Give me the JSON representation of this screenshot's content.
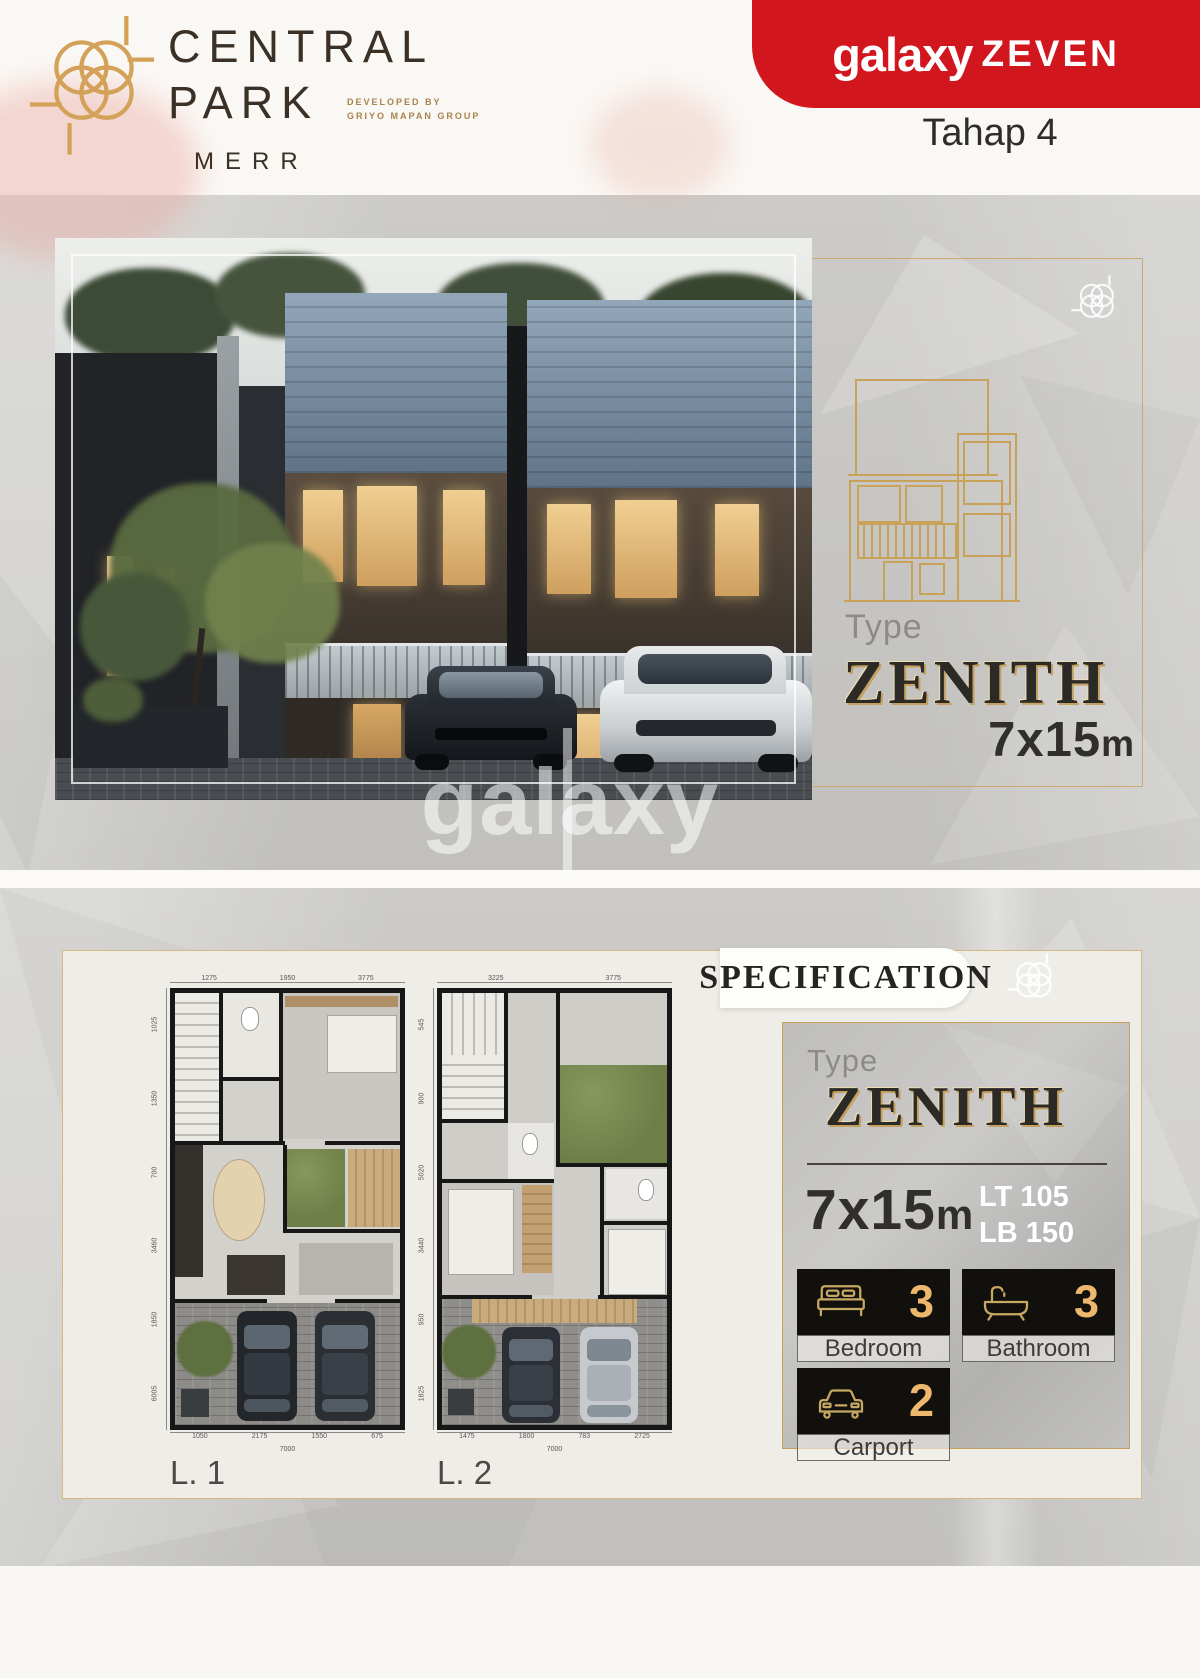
{
  "brand": {
    "line1": "CENTRAL",
    "line2": "PARK",
    "sub": "MERR",
    "dev1": "DEVELOPED BY",
    "dev2": "GRIYO MAPAN GROUP"
  },
  "banner": {
    "galaxy": "galaxy",
    "zeven": "ZEVEN",
    "phase": "Tahap 4",
    "red": "#d2161e"
  },
  "hero": {
    "type_label": "Type",
    "type_name": "ZENITH",
    "size": "7x15",
    "unit": "m",
    "watermark": "galaxy"
  },
  "spec": {
    "heading": "SPECIFICATION",
    "type_label": "Type",
    "type_name": "ZENITH",
    "size": "7x15",
    "unit": "m",
    "lt": "LT 105",
    "lb": "LB 150",
    "stats": [
      {
        "icon": "bed-icon",
        "value": "3",
        "label": "Bedroom"
      },
      {
        "icon": "bathtub-icon",
        "value": "3",
        "label": "Bathroom"
      },
      {
        "icon": "car-icon",
        "value": "2",
        "label": "Carport"
      }
    ]
  },
  "floorplans": {
    "plans": [
      {
        "label": "L. 1",
        "top_dims": [
          "1275",
          "1950",
          "3775"
        ],
        "left_dims": [
          "1025",
          "1350",
          "700",
          "3460",
          "1850",
          "6005"
        ],
        "bottom_dims": [
          "1050",
          "2175",
          "1550",
          "675"
        ],
        "bottom_total": "7000"
      },
      {
        "label": "L. 2",
        "top_dims": [
          "3225",
          "3775"
        ],
        "left_dims": [
          "545",
          "900",
          "5020",
          "3440",
          "950",
          "1825"
        ],
        "bottom_dims": [
          "1475",
          "1800",
          "783",
          "2725"
        ],
        "bottom_total": "7000"
      }
    ]
  },
  "colors": {
    "gold": "#c8a258",
    "dark_text": "#2c2a27"
  }
}
